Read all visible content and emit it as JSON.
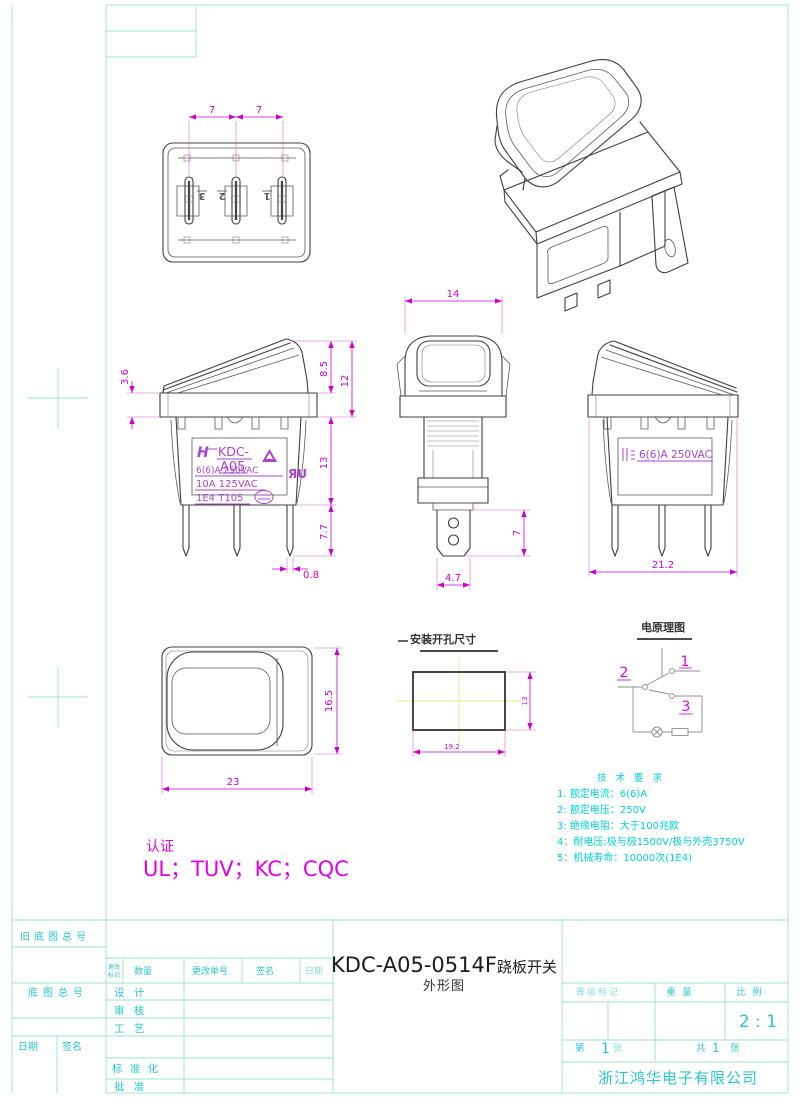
{
  "views": {
    "bottom": {
      "dim_a": "7",
      "dim_b": "7",
      "pins": [
        "3",
        "2",
        "1"
      ]
    },
    "front": {
      "dim_flange": "3.6",
      "dim_rocker_h": "8.5",
      "dim_total_h": "12",
      "dim_body_h": "13",
      "dim_pin_h": "7.7",
      "dim_pin_t": "0.8",
      "marking": {
        "brand": "KDC-",
        "model": "A05",
        "r1": "6(6)A 250VAC",
        "r2": "10A 125VAC",
        "r3": "1E4  T105",
        "ul_mark": "ЯU",
        "logo": "H"
      }
    },
    "side": {
      "dim_w": "14",
      "dim_term_l": "7",
      "dim_term_w": "4.7"
    },
    "back": {
      "dim_l": "21.2",
      "marking": "6(6)A 250VAC"
    },
    "top": {
      "dim_h": "16.5",
      "dim_w": "23"
    },
    "cutout": {
      "title": "安装开孔尺寸",
      "dim_w": "19.2",
      "dim_h": "13"
    },
    "circuit": {
      "title": "电原理图",
      "t1": "1",
      "t2": "2",
      "t3": "3"
    }
  },
  "tech": {
    "title": "技 术 要 求",
    "items": [
      "1. 额定电流：6(6)A",
      "2: 额定电压：250V",
      "3: 绝缘电阻：大于100兆欧",
      "4：耐电压:极与极1500V/极与外壳3750V",
      "5：机械寿命：10000次(1E4)"
    ]
  },
  "cert": {
    "label": "认证",
    "value": "UL；TUV；KC；CQC"
  },
  "titleblock": {
    "old_base_no": "旧底图总号",
    "base_no": "底图总号",
    "date": "日期",
    "sign": "签名",
    "change_mark1": "更改",
    "change_mark2": "标记",
    "qty": "数量",
    "change_no": "更改单号",
    "sign2": "签名",
    "date2": "日期",
    "design": "设 计",
    "check": "审 核",
    "process": "工 艺",
    "standard": "标 准 化",
    "approve": "批 准",
    "grade": "等级标记",
    "weight": "重 量",
    "scale_label": "比 例",
    "scale": "2 : 1",
    "sheet_l1": "第",
    "sheet_no": "1",
    "sheet_l2": "张",
    "total_l1": "共",
    "total_no": "1",
    "total_l2": "张",
    "company": "浙江鸿华电子有限公司",
    "title_main": "KDC-A05-0514F",
    "title_cn": "跷板开关",
    "title_sub": "外形图"
  }
}
